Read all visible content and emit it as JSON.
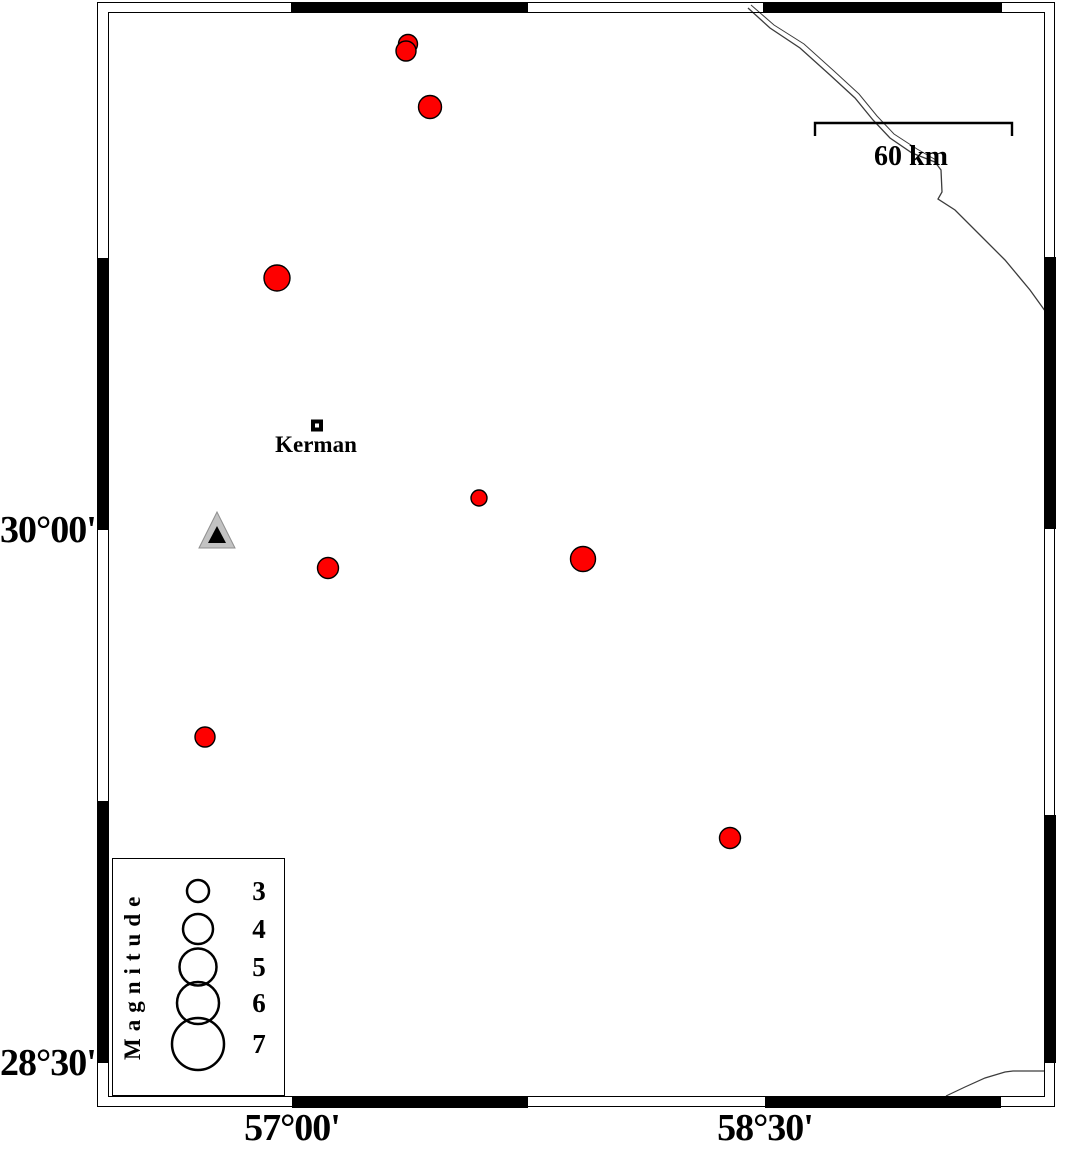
{
  "axes": {
    "left_labels": [
      {
        "text": "30°00'",
        "y": 530
      },
      {
        "text": "28°30'",
        "y": 1063
      }
    ],
    "bottom_labels": [
      {
        "text": "57°00'",
        "x": 292
      },
      {
        "text": "58°30'",
        "x": 765
      }
    ]
  },
  "frame": {
    "black_segments": [
      {
        "side": "top",
        "from": 291,
        "to": 528
      },
      {
        "side": "top",
        "from": 763,
        "to": 1002
      },
      {
        "side": "bottom",
        "from": 292,
        "to": 528
      },
      {
        "side": "bottom",
        "from": 765,
        "to": 1001
      },
      {
        "side": "left",
        "from": 258,
        "to": 530
      },
      {
        "side": "left",
        "from": 801,
        "to": 1063
      },
      {
        "side": "right",
        "from": 257,
        "to": 529
      },
      {
        "side": "right",
        "from": 815,
        "to": 1063
      }
    ]
  },
  "scale_bar": {
    "label": "60 km",
    "x1": 815,
    "x2": 1012,
    "y": 123,
    "tick_drop": 13
  },
  "city": {
    "label": "Kerman",
    "marker": {
      "x": 313,
      "y": 421.5,
      "w": 8,
      "h": 8,
      "stroke_width": 4
    }
  },
  "station": {
    "outer_points": "217,512 199,548 235,548",
    "inner_points": "217,526 208,543 226,543"
  },
  "earthquakes": [
    {
      "cx": 408,
      "cy": 44,
      "r": 9.5
    },
    {
      "cx": 406,
      "cy": 51,
      "r": 10
    },
    {
      "cx": 430,
      "cy": 107,
      "r": 11.5
    },
    {
      "cx": 277,
      "cy": 278,
      "r": 13
    },
    {
      "cx": 479,
      "cy": 498,
      "r": 8
    },
    {
      "cx": 583,
      "cy": 559,
      "r": 12.5
    },
    {
      "cx": 328,
      "cy": 568,
      "r": 10.5
    },
    {
      "cx": 205,
      "cy": 737,
      "r": 10
    },
    {
      "cx": 730,
      "cy": 838,
      "r": 10.5
    }
  ],
  "fault_lines": [
    {
      "points": "751,5 774,25 804,44 834,71 859,94 877,116 894,134 917,149 936,160",
      "width": 1
    },
    {
      "points": "748,8 770,28 800,48 830,75 855,98 873,120 890,138 912,153 935,162 941,170 942,192 938,199 955,210 980,235 1005,260 1030,290 1048,315",
      "width": 1.3
    },
    {
      "points": "946,1096 965,1087 985,1078 1005,1072 1013,1071 1045,1071",
      "width": 1.2
    }
  ],
  "legend": {
    "title": "Magnitude",
    "circle_cx": 198,
    "entries": [
      {
        "label": "3",
        "cy": 891,
        "r": 11
      },
      {
        "label": "4",
        "cy": 929,
        "r": 15
      },
      {
        "label": "5",
        "cy": 967,
        "r": 18.5
      },
      {
        "label": "6",
        "cy": 1003,
        "r": 21
      },
      {
        "label": "7",
        "cy": 1044,
        "r": 26
      }
    ]
  },
  "colors": {
    "epicenter_fill": "#fe0000",
    "marker_outline": "#000000",
    "station_fill": "#c2c2c2",
    "station_edge": "#8f8f8f",
    "station_inner": "#000000",
    "fault_line": "#3c3c3c",
    "frame": "#000000"
  },
  "chart_data": {
    "type": "scatter",
    "title": "Earthquake epicenter map near Kerman (GMT-style)",
    "x_axis": {
      "tick_labels": [
        "57°00'",
        "58°30'"
      ],
      "pixel_x": [
        292,
        765
      ]
    },
    "y_axis": {
      "tick_labels": [
        "30°00'",
        "28°30'"
      ],
      "pixel_y": [
        530,
        1063
      ]
    },
    "scale_bar": {
      "label": "60 km",
      "length_km": 60
    },
    "legend": {
      "title": "Magnitude",
      "values": [
        3,
        4,
        5,
        6,
        7
      ],
      "radii_px": [
        11,
        15,
        18.5,
        21,
        26
      ]
    },
    "points": [
      {
        "lon_est": 57.37,
        "lat_est": 31.37,
        "mag_est": 2.6
      },
      {
        "lon_est": 57.36,
        "lat_est": 31.35,
        "mag_est": 2.7
      },
      {
        "lon_est": 57.44,
        "lat_est": 31.19,
        "mag_est": 3.1
      },
      {
        "lon_est": 56.95,
        "lat_est": 30.71,
        "mag_est": 3.5
      },
      {
        "lon_est": 57.59,
        "lat_est": 30.09,
        "mag_est": 2.2
      },
      {
        "lon_est": 57.92,
        "lat_est": 29.92,
        "mag_est": 3.4
      },
      {
        "lon_est": 57.11,
        "lat_est": 29.89,
        "mag_est": 2.8
      },
      {
        "lon_est": 56.72,
        "lat_est": 29.42,
        "mag_est": 2.7
      },
      {
        "lon_est": 58.39,
        "lat_est": 29.13,
        "mag_est": 2.8
      }
    ],
    "station": {
      "symbol": "triangle",
      "lon_est": 56.76,
      "lat_est": 30.0
    },
    "city": {
      "name": "Kerman",
      "lon_est": 57.08,
      "lat_est": 30.3
    }
  }
}
